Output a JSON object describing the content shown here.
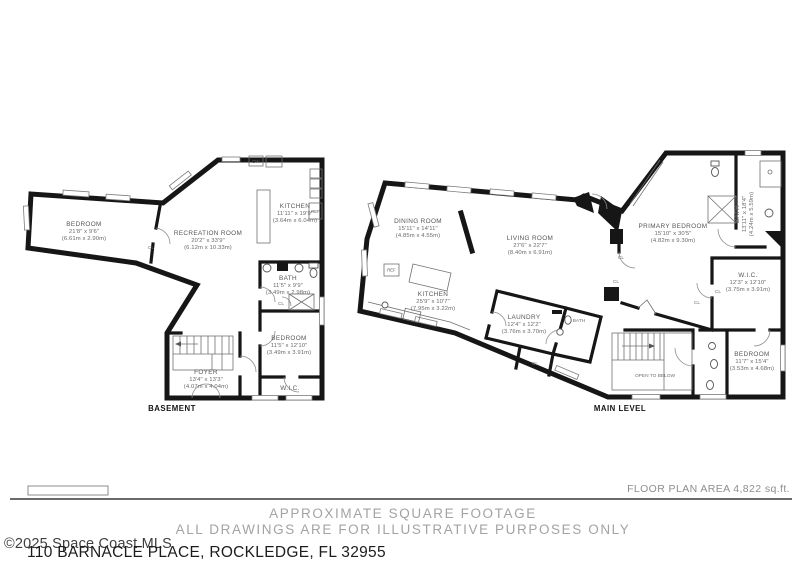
{
  "footer": {
    "floor_plan_area": "FLOOR PLAN AREA 4,822 sq.ft.",
    "disclaimer_line1": "APPROXIMATE SQUARE FOOTAGE",
    "disclaimer_line2": "ALL DRAWINGS ARE FOR ILLUSTRATIVE PURPOSES ONLY",
    "copyright": "©2025 Space Coast MLS",
    "address": "110 BARNACLE PLACE, ROCKLEDGE, FL 32955"
  },
  "labels": {
    "closet": "CL",
    "ref": "REF",
    "dw": "DW",
    "wic": "W.I.C.",
    "bath": "BATH",
    "open_to_below": "OPEN TO BELOW"
  },
  "basement": {
    "title": "BASEMENT",
    "rooms": {
      "bedroom": {
        "name": "BEDROOM",
        "dims": "21'8\" x 9'6\"",
        "metric": "(6.61m x 2.90m)"
      },
      "recreation": {
        "name": "RECREATION ROOM",
        "dims": "20'2\" x 33'9\"",
        "metric": "(6.12m x 10.33m)"
      },
      "kitchen": {
        "name": "KITCHEN",
        "dims": "11'11\" x 19'9\"",
        "metric": "(3.64m x 6.04m)"
      },
      "bath": {
        "name": "BATH",
        "dims": "11'5\" x 9'9\"",
        "metric": "(3.49m x 2.98m)"
      },
      "bedroom2": {
        "name": "BEDROOM",
        "dims": "11'5\" x 12'10\"",
        "metric": "(3.49m x 3.91m)"
      },
      "foyer": {
        "name": "FOYER",
        "dims": "13'4\" x 13'3\"",
        "metric": "(4.07m x 4.04m)"
      }
    }
  },
  "main_level": {
    "title": "MAIN LEVEL",
    "rooms": {
      "dining": {
        "name": "DINING ROOM",
        "dims": "15'11\" x 14'11\"",
        "metric": "(4.85m x 4.55m)"
      },
      "living": {
        "name": "LIVING ROOM",
        "dims": "27'6\" x 22'7\"",
        "metric": "(8.40m x 6.91m)"
      },
      "kitchen": {
        "name": "KITCHEN",
        "dims": "25'9\" x 10'7\"",
        "metric": "(7.95m x 3.22m)"
      },
      "laundry": {
        "name": "LAUNDRY",
        "dims": "12'4\" x 12'2\"",
        "metric": "(3.76m x 3.70m)"
      },
      "primary_bedroom": {
        "name": "PRIMARY BEDROOM",
        "dims": "15'10\" x 30'5\"",
        "metric": "(4.82m x 9.30m)"
      },
      "primary_bath": {
        "name": "BATH",
        "dims": "13'11\" x 18'4\"",
        "metric": "(4.24m x 5.59m)"
      },
      "wic": {
        "name": "W.I.C.",
        "dims": "12'3\" x 12'10\"",
        "metric": "(3.75m x 3.91m)"
      },
      "bedroom": {
        "name": "BEDROOM",
        "dims": "11'7\" x 15'4\"",
        "metric": "(3.53m x 4.68m)"
      }
    }
  }
}
